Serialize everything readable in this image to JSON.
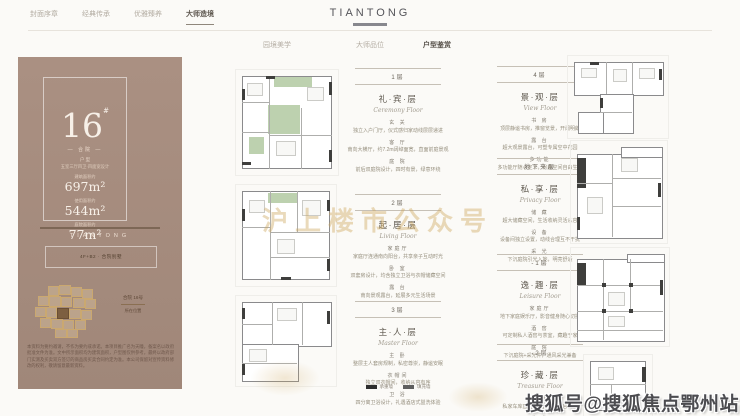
{
  "nav": {
    "items": [
      "封面序章",
      "经典传承",
      "优雅臻养",
      "大师造境"
    ],
    "active_index": 3
  },
  "logo": {
    "text": "TIANTONG"
  },
  "subnav": {
    "items": [
      "园境美学",
      "大师品位",
      "户型鉴赏"
    ],
    "active_index": 2
  },
  "unit_card": {
    "number": "16",
    "mark": "#",
    "tag": "— 合院 —",
    "type_label": "户 型",
    "type_desc": "五室三厅四卫·四面宽设计",
    "areas": [
      {
        "label": "建筑面积约",
        "value": "697m²"
      },
      {
        "label": "使用面积约",
        "value": "544m²"
      },
      {
        "label": "庭院面积约",
        "value": "77m²"
      }
    ],
    "brand": "TIANTONG",
    "spec": "4F+B2 · 合院别墅",
    "siteplan_caption_1": "合院 16号",
    "siteplan_caption_2": "所在位置",
    "disclaimer": "本资料为要约邀请，不作为要约或承诺。本项目推广名为天瞳，备案名以政府批准文件为准。文中所示面积均为建筑面积，户型图仅供参考，最终以政府部门实测及买卖双方签订的商品房买卖合同约定为准。本公司保留对宣传资料修改的权利，敬请留意最新资料。"
  },
  "floors": {
    "col1": [
      {
        "floor": "1层",
        "cn": "礼·宾·层",
        "en": "Ceremony Floor",
        "sections": [
          {
            "h": "玄 关",
            "t": "独立入户门厅，仪式感归家动线层层递进"
          },
          {
            "h": "客 厅",
            "t": "南向大横厅，约7.2m阔绰面宽，直面前庭景观"
          },
          {
            "h": "庭 院",
            "t": "前后双庭院设计，四时有景，绿意环绕"
          }
        ]
      },
      {
        "floor": "2层",
        "cn": "起·居·层",
        "en": "Living Floor",
        "sections": [
          {
            "h": "家庭厅",
            "t": "家庭厅连通南向阳台，共享亲子互动时光"
          },
          {
            "h": "卧 室",
            "t": "双套房设计，均含独立卫浴与衣帽储藏空间"
          },
          {
            "h": "露 台",
            "t": "南向景观露台，延展多元生活场景"
          }
        ]
      },
      {
        "floor": "3层",
        "cn": "主·人·层",
        "en": "Master Floor",
        "sections": [
          {
            "h": "主 卧",
            "t": "整层主人套房规制，私密尊崇，静谧安眠"
          },
          {
            "h": "衣帽间",
            "t": "独立双衣帽间，收纳从容有序"
          },
          {
            "h": "卫 浴",
            "t": "四分离卫浴设计，礼遇酒店式盥洗体验"
          }
        ]
      }
    ],
    "col2": [
      {
        "floor": "4层",
        "cn": "景·观·层",
        "en": "View Floor",
        "sections": [
          {
            "h": "书 房",
            "t": "顶层静谧书房，推窗览景，开阔明朗"
          },
          {
            "h": "露 台",
            "t": "超大观景露台，可塑专属空中花园"
          },
          {
            "h": "多功能",
            "t": "多功能厅随心定义，兴趣空间自由生长"
          }
        ]
      },
      {
        "floor": "地下夹层",
        "cn": "私·享·层",
        "en": "Privacy Floor",
        "sections": [
          {
            "h": "储 藏",
            "t": "超大储藏空间，生活收纳灵活从容"
          },
          {
            "h": "设 备",
            "t": "设备间独立设置，动线合理互不干扰"
          },
          {
            "h": "采 光",
            "t": "下沉庭院引光入地，明亮舒适"
          }
        ]
      },
      {
        "floor": "-1层",
        "cn": "逸·趣·层",
        "en": "Leisure Floor",
        "sections": [
          {
            "h": "家庭厅",
            "t": "地下家庭娱乐厅，影音健身随心切换"
          },
          {
            "h": "酒 窖",
            "t": "可定制私人酒窖与茶室，藏趣于家"
          },
          {
            "h": "庭 院",
            "t": "下沉庭院+采光井，通风采光兼备"
          }
        ]
      },
      {
        "floor": "-2层",
        "cn": "珍·藏·层",
        "en": "Treasure Floor",
        "sections": [
          {
            "h": "车 库",
            "t": "私家车库直达入户，归家从容有度"
          },
          {
            "h": "收 藏",
            "t": "恒温恒湿珍藏空间，礼遇心爱之物"
          }
        ]
      }
    ]
  },
  "legend": {
    "items": [
      {
        "color": "#2e2e2e",
        "label": "承重墙"
      },
      {
        "color": "#5f5f5f",
        "label": "填充墙"
      }
    ]
  },
  "watermarks": {
    "gold": "沪上楼市公众号",
    "sohu": "搜狐号@搜狐焦点鄂州站"
  },
  "colors": {
    "card_brown": "#a58c7e",
    "gold": "#cca65e",
    "green_garden": "#abc498",
    "accent_dark": "#57514a"
  }
}
